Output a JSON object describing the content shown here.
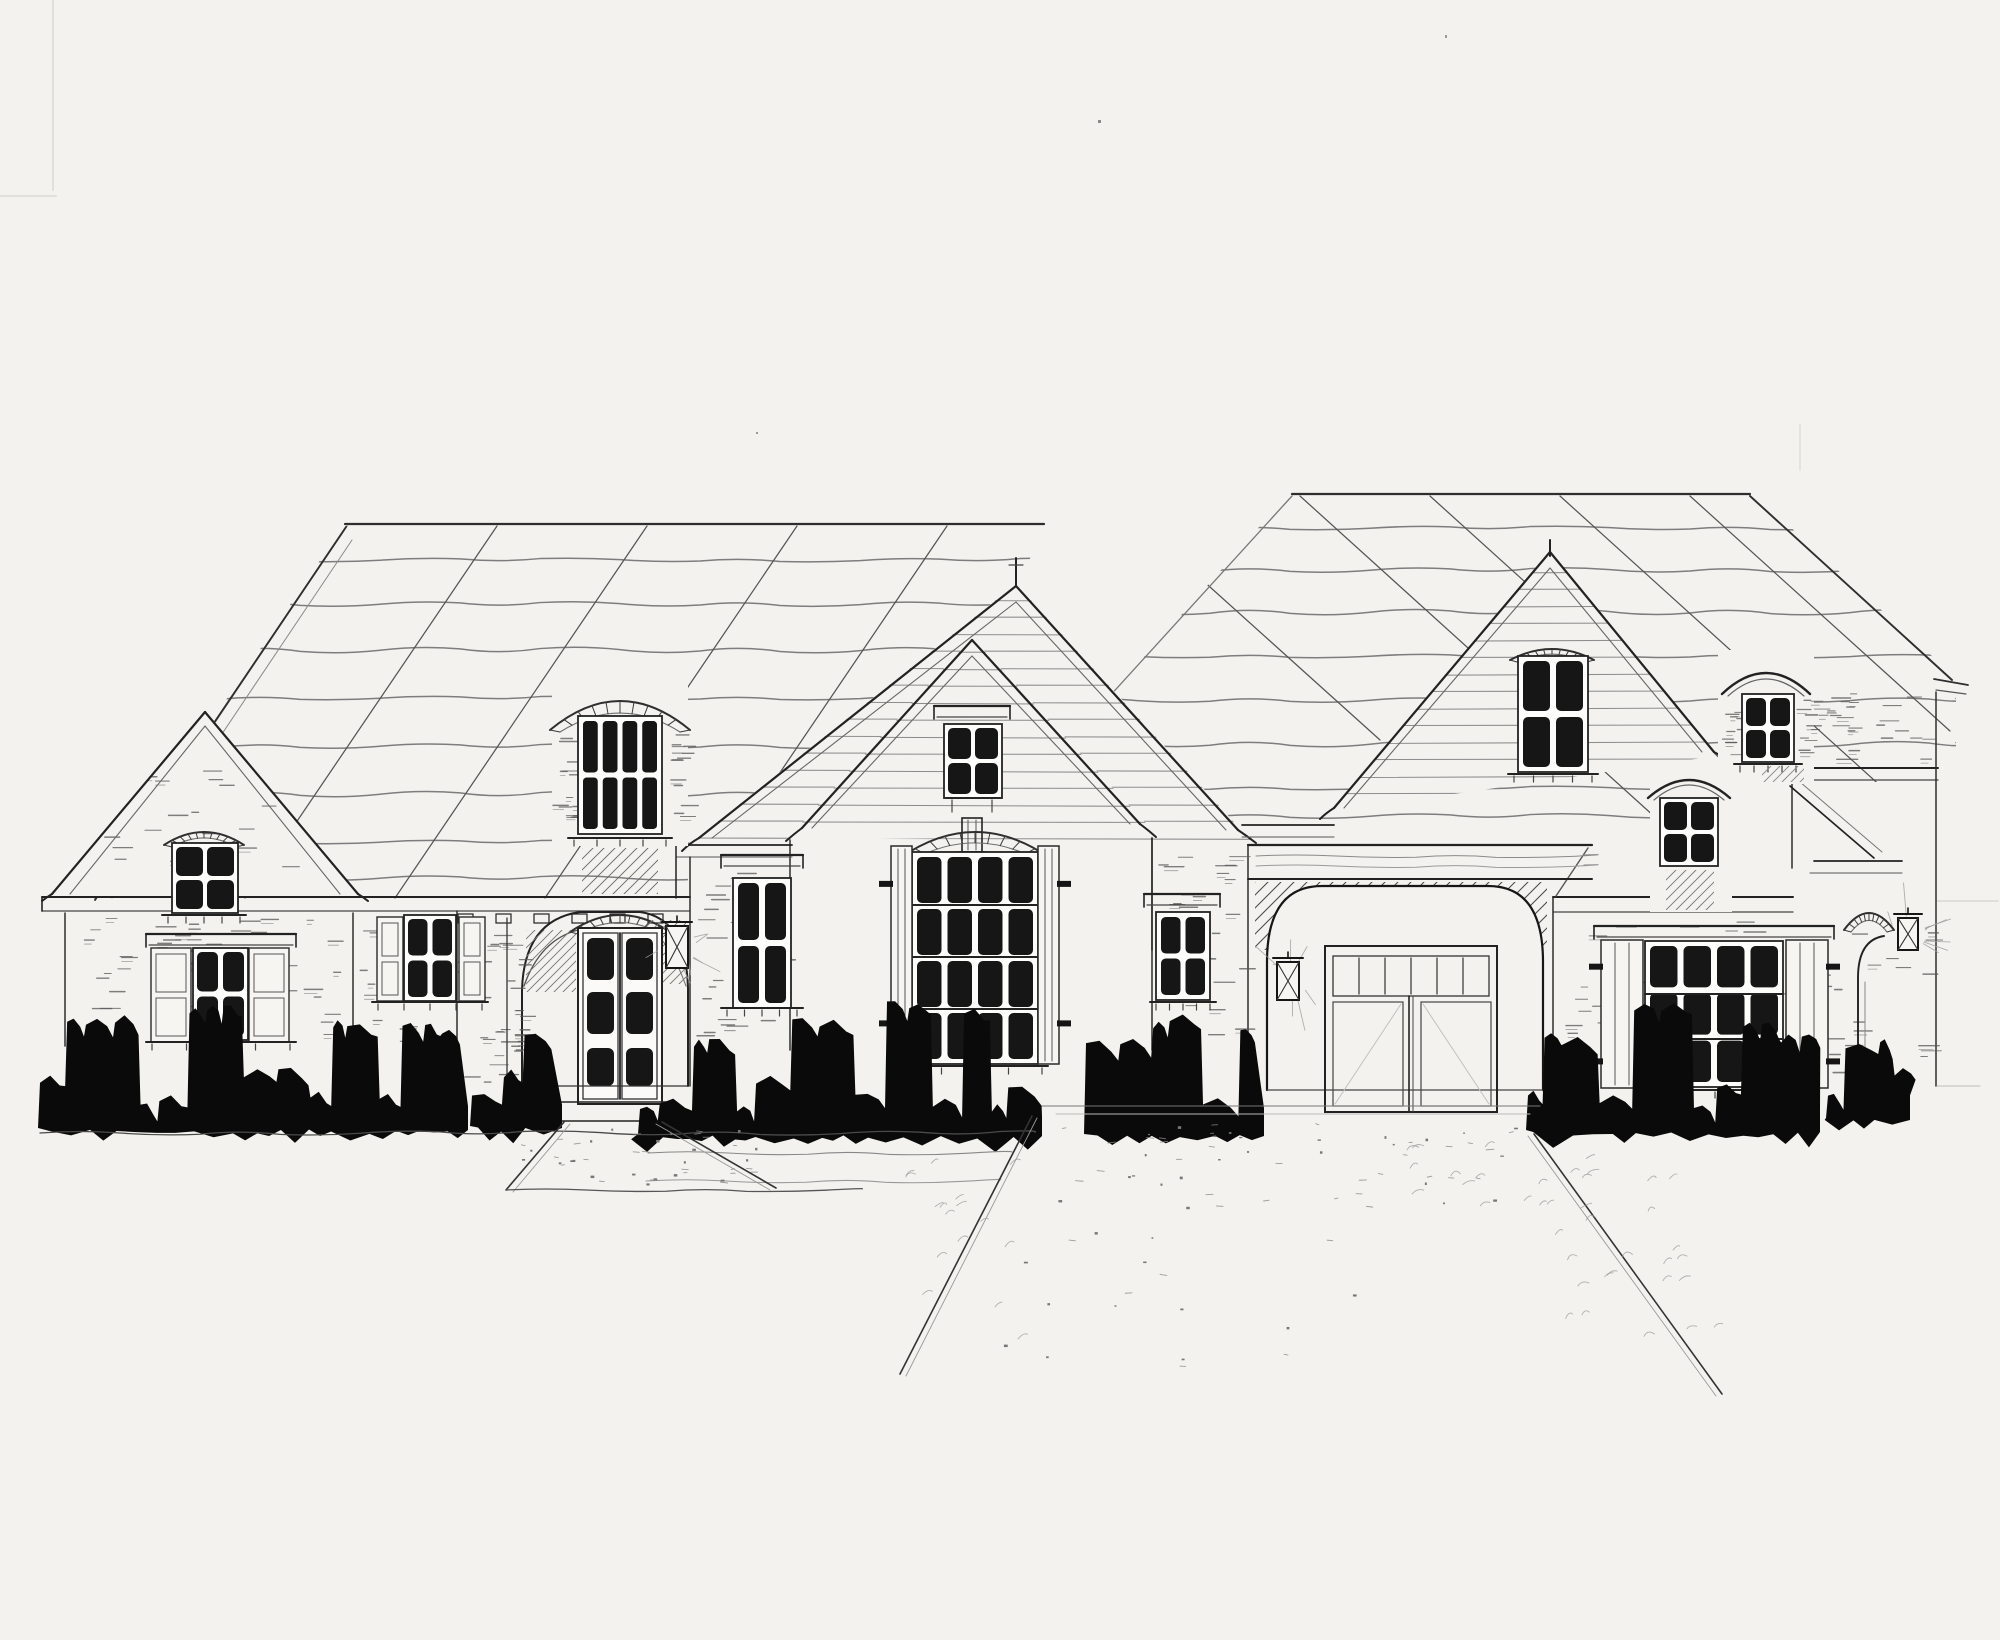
{
  "artwork": {
    "kind": "hand-drawn architectural front elevation sketch",
    "medium": "graphite and ink on white paper, scanned",
    "description": "Front elevation sketch of a French-country style house: steep shingled roofs with diagonal hatch marks, a tall nested central gable holding a large arched multi-pane window with board-and-batten shutters, an arched entry with a glazed double door and lantern, wall dormers and roof dormers with small arched windows, an arched double garage with a hanging lantern, a far-right arched side entry, shuttered windows on both wings, solid black foundation shrubs, a front walkway and a flared driveway.",
    "visible_text": []
  },
  "palette": {
    "paper": "#f3f2ef",
    "ink": "#161616",
    "line_dark": "#2e2e2e",
    "line_mid": "#6f6f6f",
    "pencil": "#8f8f8f",
    "pencil_light": "#c9c8c4",
    "foliage": "#0a0a0a"
  },
  "elements": [
    {
      "name": "left-roof",
      "description": "large hipped roof plane with wavy shingle courses and diagonal hatch lines"
    },
    {
      "name": "right-roof",
      "description": "second hipped roof plane over the garage and right wing"
    },
    {
      "name": "left-gable",
      "description": "small front-facing gable on the far left wing"
    },
    {
      "name": "left-gable-window",
      "description": "arched 4-pane window at the left gable eave"
    },
    {
      "name": "left-wing-window",
      "description": "4-pane window with paneled shutters on the left wing wall"
    },
    {
      "name": "side-window",
      "description": "small shuttered 4-pane window between left wing and entry"
    },
    {
      "name": "entry-dormer-window",
      "description": "arched 8-pane wall-dormer window with brick surround above the entry"
    },
    {
      "name": "dentil-band",
      "description": "dentil blocks under the entry eave"
    },
    {
      "name": "entry-arch",
      "description": "arched masonry entry opening with knee braces"
    },
    {
      "name": "entry-door",
      "description": "glazed double entry door, three dark lites per leaf"
    },
    {
      "name": "entry-lantern",
      "description": "wall lantern with radiating light strokes right of the door"
    },
    {
      "name": "window-right-of-entry",
      "description": "tall 4-pane window between entry and central gable"
    },
    {
      "name": "center-gable",
      "description": "tall nested double gable with flared eaves and horizontal siding"
    },
    {
      "name": "center-small-window",
      "description": "small 4-pane window with header board high in the central gable"
    },
    {
      "name": "center-arched-window",
      "description": "large arched window, 4x4 grid of dark panes, brick voussoir arch"
    },
    {
      "name": "center-shutters",
      "description": "board-and-batten shutters with strap hinges flanking the arched window"
    },
    {
      "name": "garage-beam",
      "description": "heavy timber header beam over the garage"
    },
    {
      "name": "garage-arch",
      "description": "wide brick-hatched arch over the garage bay"
    },
    {
      "name": "garage-door",
      "description": "double garage door with transom lites"
    },
    {
      "name": "garage-lantern",
      "description": "pendant lantern hanging in the garage arch"
    },
    {
      "name": "garage-side-window",
      "description": "small 4-pane window on the pier left of the garage"
    },
    {
      "name": "right-gable",
      "description": "large front-facing gable with horizontal siding"
    },
    {
      "name": "right-gable-window",
      "description": "tall arched 4-pane window in the right gable"
    },
    {
      "name": "roof-dormer",
      "description": "arched-hood roof dormer with 4-pane window, far right roof"
    },
    {
      "name": "wall-dormer",
      "description": "arched-hood wall dormer window at the right wing eave"
    },
    {
      "name": "right-wing-window",
      "description": "wide 4x3 dark-pane window with board shutters on the right wing"
    },
    {
      "name": "side-entry-arch",
      "description": "arched side entry with lantern at the far right bay"
    },
    {
      "name": "shrubs",
      "description": "solid black hedge and shrub silhouettes along the foundation"
    },
    {
      "name": "walkway",
      "description": "flared stippled walkway from the entry stoop"
    },
    {
      "name": "driveway",
      "description": "wide driveway flaring toward the viewer from the garage"
    }
  ]
}
